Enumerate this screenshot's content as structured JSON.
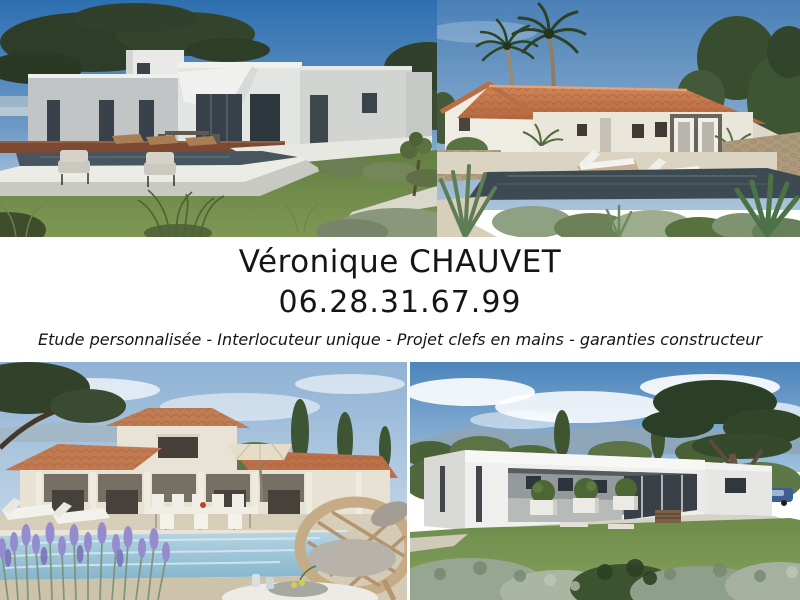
{
  "contact": {
    "name": "Véronique CHAUVET",
    "phone": "06.28.31.67.99",
    "tagline": "Etude personnalisée - Interlocuteur unique - Projet clefs en mains - garanties constructeur"
  },
  "photos": {
    "top_left": "modern-flat-roof-villa-with-umbrella-pine-and-dark-pool",
    "top_right": "provencal-villa-terracotta-roof-palm-trees-loungers-pool",
    "bottom_left": "two-storey-provencal-villa-terrace-pool-lavender-wicker-chair",
    "bottom_right": "modern-single-storey-white-villa-lawn-large-pine"
  },
  "colors": {
    "background": "#ffffff",
    "text": "#151515",
    "sky_blue": "#2d6fb0",
    "roof_terracotta": "#c1734a",
    "wall_cream": "#eae6dc",
    "wall_white": "#eff0ee",
    "pool_dark": "#46555e",
    "pool_light": "#a7cbdc",
    "lawn_green": "#6d8c4b",
    "lavender_purple": "#978bd0"
  }
}
